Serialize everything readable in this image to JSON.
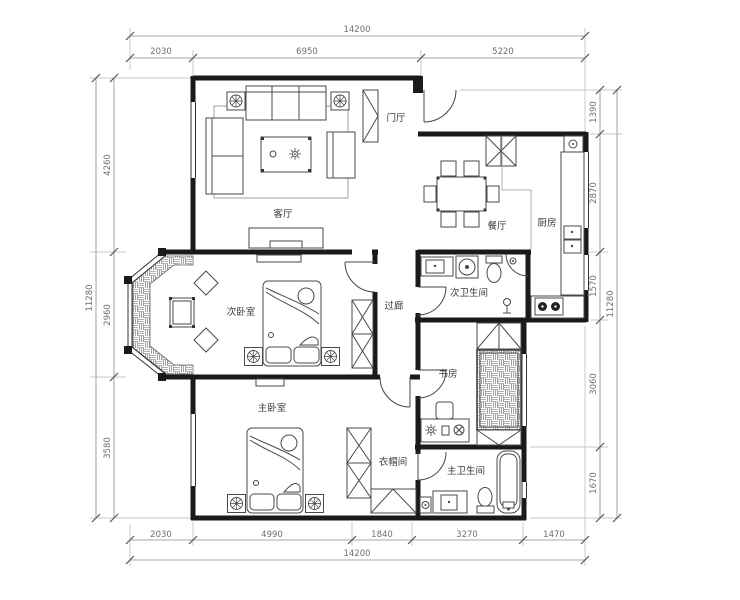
{
  "rooms": {
    "living": "客厅",
    "entry": "门厅",
    "dining": "餐厅",
    "kitchen": "厨房",
    "bedroom2": "次卧室",
    "corridor": "过廊",
    "bath2": "次卫生间",
    "study": "书房",
    "master": "主卧室",
    "closet": "衣帽间",
    "bath_master": "主卫生间"
  },
  "dims": {
    "top": {
      "total": "14200",
      "segments": [
        "2030",
        "6950",
        "5220"
      ]
    },
    "bottom": {
      "total": "14200",
      "segments": [
        "2030",
        "4990",
        "1840",
        "3270",
        "1470"
      ]
    },
    "left": {
      "total": "11280",
      "segments": [
        "4260",
        "2960",
        "3580"
      ]
    },
    "right": {
      "total": "11280",
      "segments": [
        "1390",
        "2870",
        "1570",
        "3060",
        "1670"
      ]
    }
  },
  "colors": {
    "wall": "#1a1a1a",
    "furniture": "#4a4a4a",
    "dimension": "#6e6e6e",
    "background": "#ffffff"
  }
}
